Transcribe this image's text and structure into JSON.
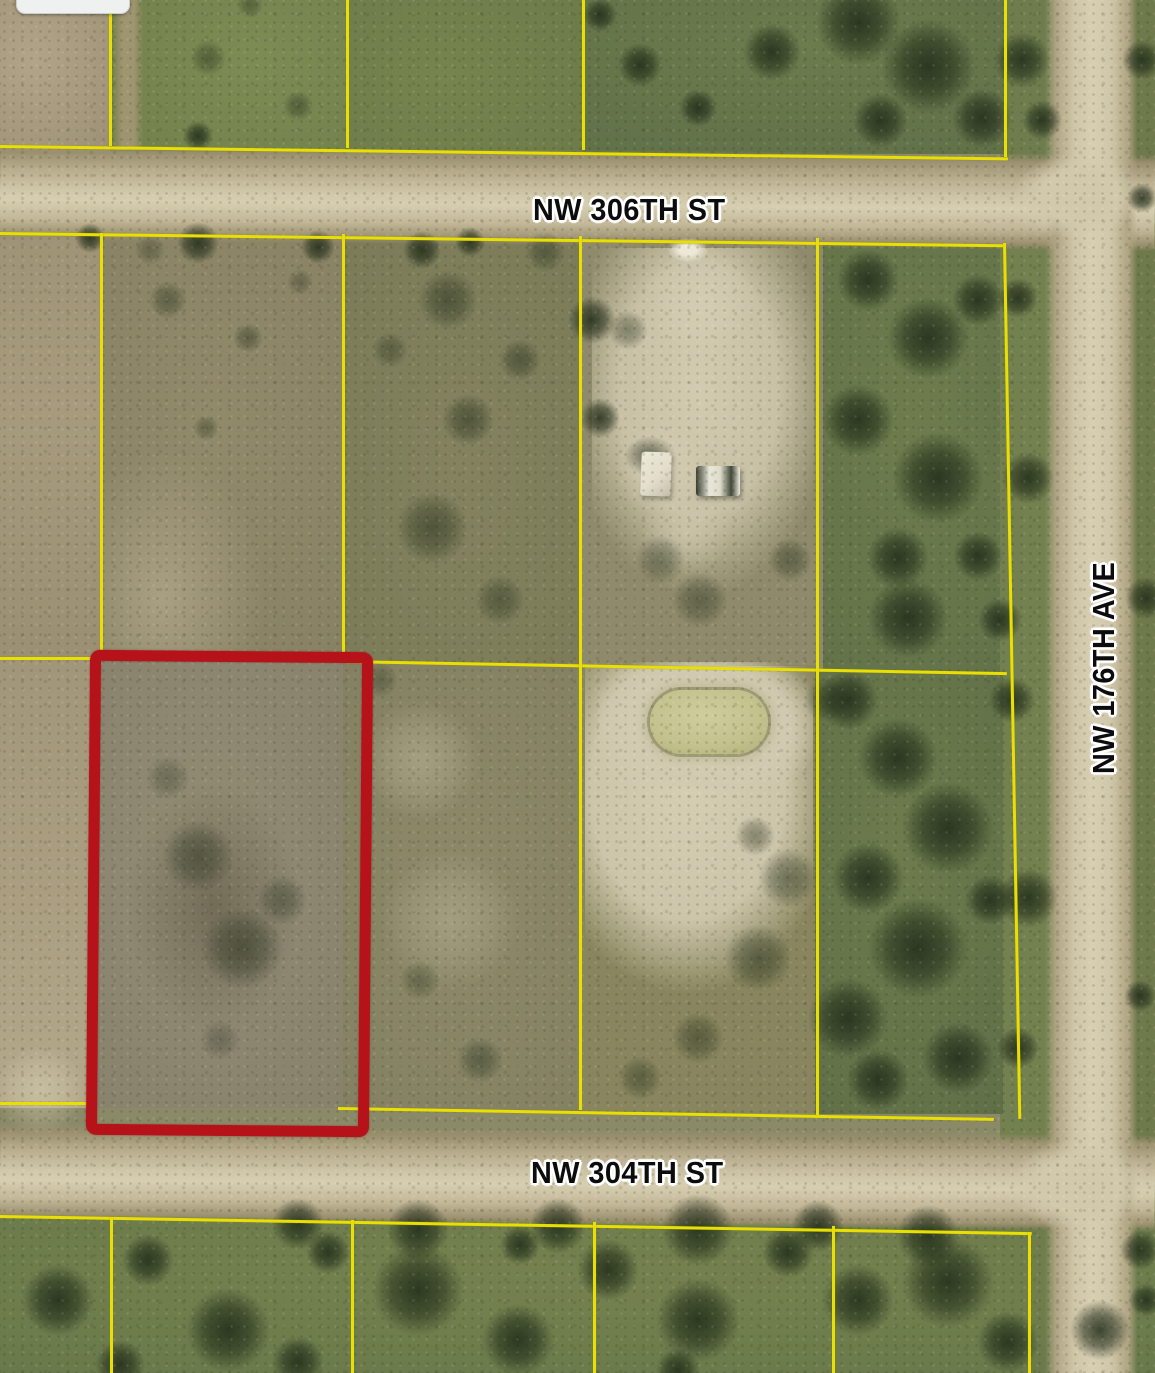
{
  "map": {
    "type": "aerial-parcel-map",
    "street_labels": {
      "top": "NW 306TH ST",
      "bottom": "NW 304TH ST",
      "right_vertical": "NW 176TH AVE"
    },
    "colors": {
      "parcel_line": "#e8df05",
      "highlight_red": "#b5121a",
      "road_surface": "#d2c9ac",
      "label_text": "#0c0c0c",
      "label_halo": "#ffffff"
    }
  }
}
